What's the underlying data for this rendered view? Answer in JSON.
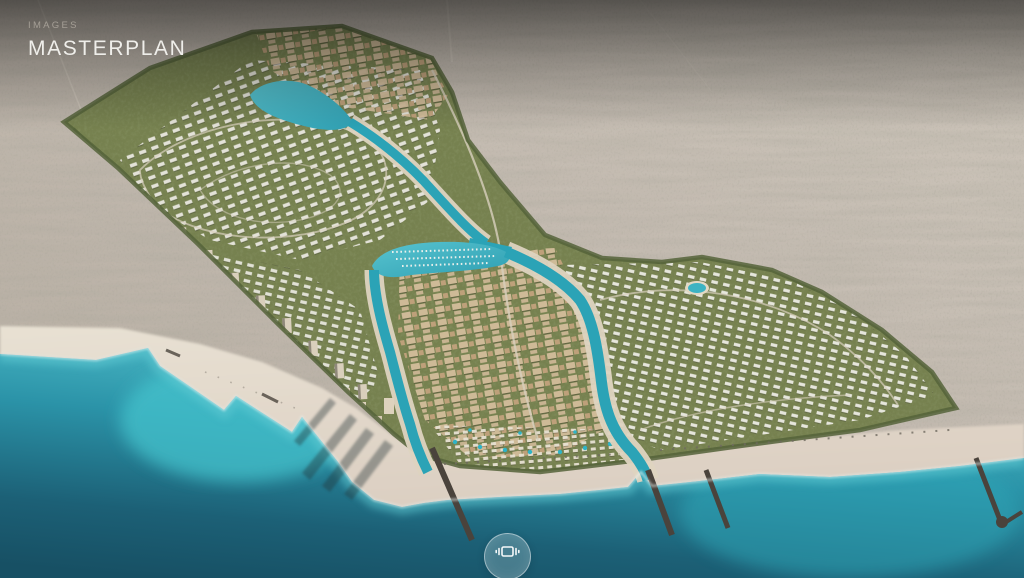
{
  "header": {
    "eyebrow": "IMAGES",
    "title": "MASTERPLAN"
  },
  "controls": {
    "pan_button": {
      "icon": "pan-360-icon"
    }
  },
  "palette": {
    "desert_base": "#c1b8ac",
    "desert_speckle": "#5f5c4e",
    "sand": "#e8e1d3",
    "sand_wet": "#dccfc2",
    "sea_deep": "#175064",
    "sea_mid": "#2b93a8",
    "sea_shallow": "#53c2cd",
    "foam": "#f0f8f5",
    "green_base": "#76814f",
    "green_dark": "#55633a",
    "villa_white": "#e9e7df",
    "downtown_beige": "#d0ba98",
    "terracotta": "#c2a27c",
    "canal": "#2ba3b6",
    "lake": "#45b7c7",
    "jetty": "#4a433c",
    "shadow": "#233036",
    "road": "#d8d0bd",
    "text_eyebrow": "#a59f96",
    "text_title": "#efeeea",
    "button_rim": "rgba(255,255,255,0.48)"
  }
}
